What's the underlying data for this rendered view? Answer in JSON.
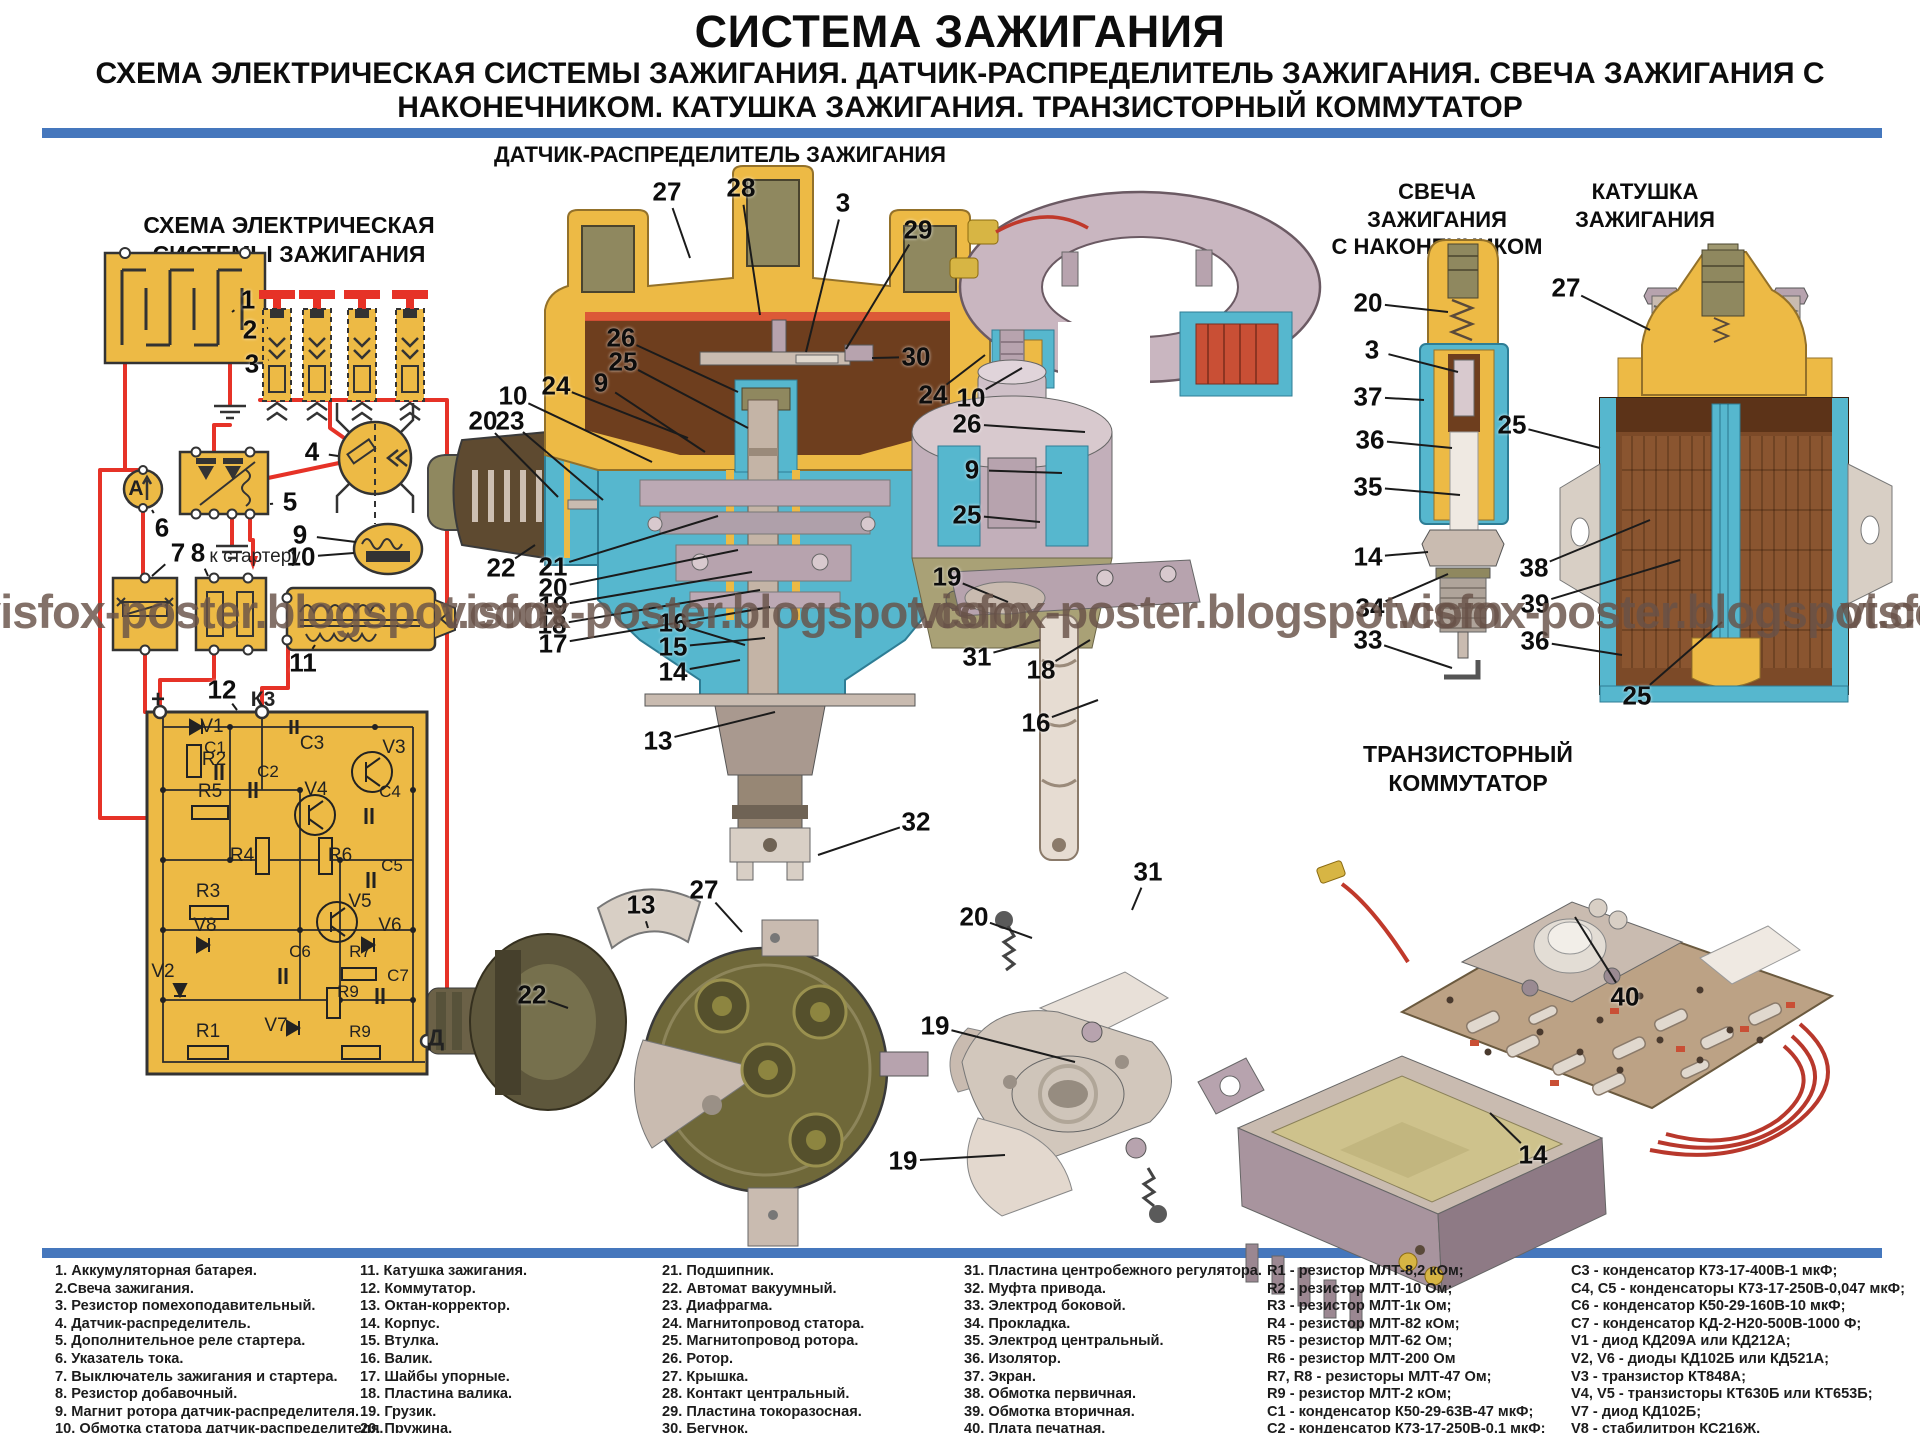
{
  "header": {
    "title": "СИСТЕМА ЗАЖИГАНИЯ",
    "subtitle_line1": "СХЕМА ЭЛЕКТРИЧЕСКАЯ СИСТЕМЫ ЗАЖИГАНИЯ. ДАТЧИК-РАСПРЕДЕЛИТЕЛЬ ЗАЖИГАНИЯ. СВЕЧА ЗАЖИГАНИЯ С",
    "subtitle_line2": "НАКОНЕЧНИКОМ. КАТУШКА ЗАЖИГАНИЯ. ТРАНЗИСТОРНЫЙ КОММУТАТОР"
  },
  "colors": {
    "divider_blue": "#4577BD",
    "schematic_yellow": "#EDBA45",
    "wire_red": "#E63227",
    "watermark_brown": "#6A5348"
  },
  "sections": {
    "schematic": {
      "title_line1": "СХЕМА ЭЛЕКТРИЧЕСКАЯ",
      "title_line2": "СИСТЕМЫ ЗАЖИГАНИЯ"
    },
    "distributor": {
      "title": "ДАТЧИК-РАСПРЕДЕЛИТЕЛЬ ЗАЖИГАНИЯ"
    },
    "spark_plug": {
      "title_line1": "СВЕЧА ЗАЖИГАНИЯ",
      "title_line2": "С НАКОНЕЧНИКОМ"
    },
    "coil": {
      "title_line1": "КАТУШКА",
      "title_line2": "ЗАЖИГАНИЯ"
    },
    "commutator": {
      "title": "ТРАНЗИСТОРНЫЙ КОММУТАТОР"
    }
  },
  "watermark": {
    "text": "visfox-poster.blogspot.com",
    "y": 588,
    "positions_x": [
      -25,
      440,
      915,
      1395,
      1840
    ]
  },
  "schematic_labels": {
    "items": [
      {
        "t": "А",
        "x": 136,
        "y": 489,
        "s": 21,
        "b": 1
      },
      {
        "t": "к стартеру",
        "x": 255,
        "y": 557,
        "s": 19
      },
      {
        "t": "+",
        "x": 158,
        "y": 700,
        "s": 24,
        "b": 1
      },
      {
        "t": "К3",
        "x": 263,
        "y": 700,
        "s": 21,
        "b": 1
      },
      {
        "t": "Д",
        "x": 436,
        "y": 1038,
        "s": 23,
        "b": 1
      },
      {
        "t": "V1",
        "x": 212,
        "y": 727
      },
      {
        "t": "R2",
        "x": 214,
        "y": 760
      },
      {
        "t": "C1",
        "x": 215,
        "y": 748,
        "s": 17
      },
      {
        "t": "C2",
        "x": 268,
        "y": 772,
        "s": 17
      },
      {
        "t": "C3",
        "x": 312,
        "y": 744
      },
      {
        "t": "V3",
        "x": 394,
        "y": 748
      },
      {
        "t": "R5",
        "x": 210,
        "y": 792
      },
      {
        "t": "V4",
        "x": 316,
        "y": 790
      },
      {
        "t": "C4",
        "x": 390,
        "y": 792,
        "s": 17
      },
      {
        "t": "R4",
        "x": 242,
        "y": 856
      },
      {
        "t": "R6",
        "x": 340,
        "y": 856
      },
      {
        "t": "C5",
        "x": 392,
        "y": 866,
        "s": 17
      },
      {
        "t": "R3",
        "x": 208,
        "y": 892
      },
      {
        "t": "V5",
        "x": 360,
        "y": 902
      },
      {
        "t": "V8",
        "x": 205,
        "y": 926
      },
      {
        "t": "V6",
        "x": 390,
        "y": 926
      },
      {
        "t": "C6",
        "x": 300,
        "y": 952,
        "s": 17
      },
      {
        "t": "R7",
        "x": 360,
        "y": 952,
        "s": 17
      },
      {
        "t": "V2",
        "x": 163,
        "y": 972
      },
      {
        "t": "R9",
        "x": 348,
        "y": 992,
        "s": 17
      },
      {
        "t": "C7",
        "x": 398,
        "y": 976,
        "s": 17
      },
      {
        "t": "V7",
        "x": 276,
        "y": 1026
      },
      {
        "t": "R1",
        "x": 208,
        "y": 1032
      },
      {
        "t": "R9",
        "x": 360,
        "y": 1032,
        "s": 17
      }
    ]
  },
  "callouts": [
    {
      "t": "1",
      "x": 248,
      "y": 300,
      "ex": 232,
      "ey": 312
    },
    {
      "t": "2",
      "x": 250,
      "y": 330,
      "ex": 268,
      "ey": 328
    },
    {
      "t": "3",
      "x": 252,
      "y": 364,
      "ex": 268,
      "ey": 360
    },
    {
      "t": "4",
      "x": 312,
      "y": 452,
      "ex": 338,
      "ey": 456
    },
    {
      "t": "5",
      "x": 290,
      "y": 502,
      "ex": 270,
      "ey": 504
    },
    {
      "t": "6",
      "x": 162,
      "y": 528,
      "ex": 152,
      "ey": 510
    },
    {
      "t": "7",
      "x": 178,
      "y": 553,
      "ex": 152,
      "ey": 576
    },
    {
      "t": "8",
      "x": 198,
      "y": 553,
      "ex": 208,
      "ey": 576
    },
    {
      "t": "9",
      "x": 300,
      "y": 535,
      "ex": 356,
      "ey": 542
    },
    {
      "t": "10",
      "x": 301,
      "y": 557,
      "ex": 354,
      "ey": 553
    },
    {
      "t": "11",
      "x": 303,
      "y": 663,
      "ex": 315,
      "ey": 645
    },
    {
      "t": "12",
      "x": 222,
      "y": 690,
      "ex": 237,
      "ey": 710
    },
    {
      "t": "27",
      "x": 667,
      "y": 192,
      "ex": 690,
      "ey": 258
    },
    {
      "t": "28",
      "x": 741,
      "y": 188,
      "ex": 760,
      "ey": 315
    },
    {
      "t": "3",
      "x": 843,
      "y": 203,
      "ex": 806,
      "ey": 352
    },
    {
      "t": "29",
      "x": 918,
      "y": 230,
      "ex": 846,
      "ey": 349
    },
    {
      "t": "30",
      "x": 916,
      "y": 357,
      "ex": 872,
      "ey": 358
    },
    {
      "t": "26",
      "x": 621,
      "y": 338,
      "ex": 738,
      "ey": 392
    },
    {
      "t": "25",
      "x": 623,
      "y": 362,
      "ex": 748,
      "ey": 428
    },
    {
      "t": "24",
      "x": 556,
      "y": 386,
      "ex": 688,
      "ey": 438
    },
    {
      "t": "9",
      "x": 601,
      "y": 383,
      "ex": 705,
      "ey": 452
    },
    {
      "t": "10",
      "x": 513,
      "y": 396,
      "ex": 652,
      "ey": 462
    },
    {
      "t": "20",
      "x": 483,
      "y": 421,
      "ex": 558,
      "ey": 497
    },
    {
      "t": "23",
      "x": 510,
      "y": 421,
      "ex": 603,
      "ey": 500
    },
    {
      "t": "22",
      "x": 501,
      "y": 568,
      "ex": 535,
      "ey": 545
    },
    {
      "t": "21",
      "x": 553,
      "y": 567,
      "ex": 718,
      "ey": 516
    },
    {
      "t": "20",
      "x": 553,
      "y": 588,
      "ex": 738,
      "ey": 550
    },
    {
      "t": "19",
      "x": 553,
      "y": 606,
      "ex": 752,
      "ey": 572
    },
    {
      "t": "18",
      "x": 552,
      "y": 625,
      "ex": 760,
      "ey": 590
    },
    {
      "t": "17",
      "x": 553,
      "y": 644,
      "ex": 770,
      "ey": 607
    },
    {
      "t": "16",
      "x": 673,
      "y": 623,
      "ex": 745,
      "ey": 645
    },
    {
      "t": "15",
      "x": 673,
      "y": 647,
      "ex": 765,
      "ey": 638
    },
    {
      "t": "14",
      "x": 673,
      "y": 672,
      "ex": 740,
      "ey": 660
    },
    {
      "t": "13",
      "x": 658,
      "y": 741,
      "ex": 775,
      "ey": 712
    },
    {
      "t": "32",
      "x": 916,
      "y": 822,
      "ex": 818,
      "ey": 855
    },
    {
      "t": "13",
      "x": 641,
      "y": 905,
      "ex": 648,
      "ey": 928
    },
    {
      "t": "27",
      "x": 704,
      "y": 890,
      "ex": 742,
      "ey": 932
    },
    {
      "t": "22",
      "x": 532,
      "y": 995,
      "ex": 568,
      "ey": 1008
    },
    {
      "t": "24",
      "x": 933,
      "y": 395,
      "ex": 985,
      "ey": 355
    },
    {
      "t": "10",
      "x": 971,
      "y": 398,
      "ex": 1022,
      "ey": 368
    },
    {
      "t": "26",
      "x": 967,
      "y": 424,
      "ex": 1085,
      "ey": 432
    },
    {
      "t": "9",
      "x": 972,
      "y": 470,
      "ex": 1062,
      "ey": 473
    },
    {
      "t": "25",
      "x": 967,
      "y": 515,
      "ex": 1040,
      "ey": 522
    },
    {
      "t": "19",
      "x": 947,
      "y": 577,
      "ex": 1008,
      "ey": 602
    },
    {
      "t": "31",
      "x": 977,
      "y": 657,
      "ex": 1040,
      "ey": 640
    },
    {
      "t": "18",
      "x": 1041,
      "y": 670,
      "ex": 1090,
      "ey": 640
    },
    {
      "t": "16",
      "x": 1036,
      "y": 723,
      "ex": 1098,
      "ey": 700
    },
    {
      "t": "31",
      "x": 1148,
      "y": 872,
      "ex": 1132,
      "ey": 910
    },
    {
      "t": "20",
      "x": 974,
      "y": 917,
      "ex": 1032,
      "ey": 938
    },
    {
      "t": "19",
      "x": 935,
      "y": 1026,
      "ex": 1075,
      "ey": 1062
    },
    {
      "t": "19",
      "x": 903,
      "y": 1161,
      "ex": 1005,
      "ey": 1155
    },
    {
      "t": "20",
      "x": 1368,
      "y": 303,
      "ex": 1448,
      "ey": 312
    },
    {
      "t": "3",
      "x": 1372,
      "y": 350,
      "ex": 1458,
      "ey": 372
    },
    {
      "t": "37",
      "x": 1368,
      "y": 397,
      "ex": 1424,
      "ey": 400
    },
    {
      "t": "36",
      "x": 1370,
      "y": 440,
      "ex": 1452,
      "ey": 448
    },
    {
      "t": "35",
      "x": 1368,
      "y": 487,
      "ex": 1460,
      "ey": 495
    },
    {
      "t": "14",
      "x": 1368,
      "y": 557,
      "ex": 1428,
      "ey": 552
    },
    {
      "t": "34",
      "x": 1370,
      "y": 608,
      "ex": 1448,
      "ey": 574
    },
    {
      "t": "33",
      "x": 1368,
      "y": 640,
      "ex": 1452,
      "ey": 668
    },
    {
      "t": "27",
      "x": 1566,
      "y": 288,
      "ex": 1650,
      "ey": 330
    },
    {
      "t": "25",
      "x": 1512,
      "y": 425,
      "ex": 1600,
      "ey": 448
    },
    {
      "t": "38",
      "x": 1534,
      "y": 568,
      "ex": 1650,
      "ey": 520
    },
    {
      "t": "39",
      "x": 1535,
      "y": 604,
      "ex": 1680,
      "ey": 560
    },
    {
      "t": "36",
      "x": 1535,
      "y": 641,
      "ex": 1622,
      "ey": 655
    },
    {
      "t": "25",
      "x": 1637,
      "y": 696,
      "ex": 1722,
      "ey": 622
    },
    {
      "t": "40",
      "x": 1625,
      "y": 997,
      "ex": 1575,
      "ey": 917
    },
    {
      "t": "14",
      "x": 1533,
      "y": 1155,
      "ex": 1490,
      "ey": 1113
    }
  ],
  "legend": {
    "columns": [
      {
        "items": [
          "1. Аккумуляторная батарея.",
          "2.Свеча зажигания.",
          "3. Резистор помехоподавительный.",
          "4. Датчик-распределитель.",
          "5. Дополнительное реле стартера.",
          "6. Указатель тока.",
          "7. Выключатель зажигания и стартера.",
          "8. Резистор добавочный.",
          "9. Магнит ротора датчик-распределителя.",
          "10. Обмотка статора датчик-распределителя."
        ]
      },
      {
        "items": [
          "11. Катушка зажигания.",
          "12. Коммутатор.",
          "13. Октан-корректор.",
          "14. Корпус.",
          "15. Втулка.",
          "16. Валик.",
          "17. Шайбы упорные.",
          "18. Пластина валика.",
          "19. Грузик.",
          "20. Пружина."
        ]
      },
      {
        "items": [
          "21. Подшипник.",
          "22. Автомат вакуумный.",
          "23. Диафрагма.",
          "24. Магнитопровод статора.",
          "25. Магнитопровод ротора.",
          "26. Ротор.",
          "27. Крышка.",
          "28. Контакт центральный.",
          "29. Пластина токоразосная.",
          "30. Бегунок."
        ]
      },
      {
        "items": [
          "31. Пластина центробежного регулятора.",
          "32. Муфта привода.",
          "33. Электрод боковой.",
          "34. Прокладка.",
          "35. Электрод центральный.",
          "36. Изолятор.",
          "37. Экран.",
          "38. Обмотка первичная.",
          "39. Обмотка вторичная.",
          "40. Плата печатная."
        ]
      },
      {
        "items": [
          "R1 - резистор МЛТ-8,2 кОм;",
          "R2 - резистор МЛТ-10 Ом;",
          "R3 - резистор МЛТ-1к Ом;",
          "R4 - резистор МЛТ-82 кОм;",
          "R5 - резистор МЛТ-62 Ом;",
          "R6 - резистор МЛТ-200 Ом",
          "R7, R8 - резисторы МЛТ-47 Ом;",
          "R9 - резистор МЛТ-2 кОм;",
          "C1 - конденсатор К50-29-63В-47 мкФ;",
          "C2 - конденсатор К73-17-250В-0,1 мкФ;"
        ]
      },
      {
        "items": [
          "C3 - конденсатор К73-17-400В-1 мкФ;",
          "C4, C5 - конденсаторы К73-17-250В-0,047 мкФ;",
          "C6 - конденсатор К50-29-160В-10 мкФ;",
          "C7 - конденсатор КД-2-Н20-500В-1000 Ф;",
          "V1 - диод КД209А или КД212А;",
          "V2, V6 - диоды КД102Б или КД521А;",
          "V3 - транзистор КТ848А;",
          "V4, V5 - транзисторы КТ630Б или КТ653Б;",
          "V7 - диод КД102Б;",
          "V8 - стабилитрон КС216Ж."
        ]
      }
    ]
  }
}
